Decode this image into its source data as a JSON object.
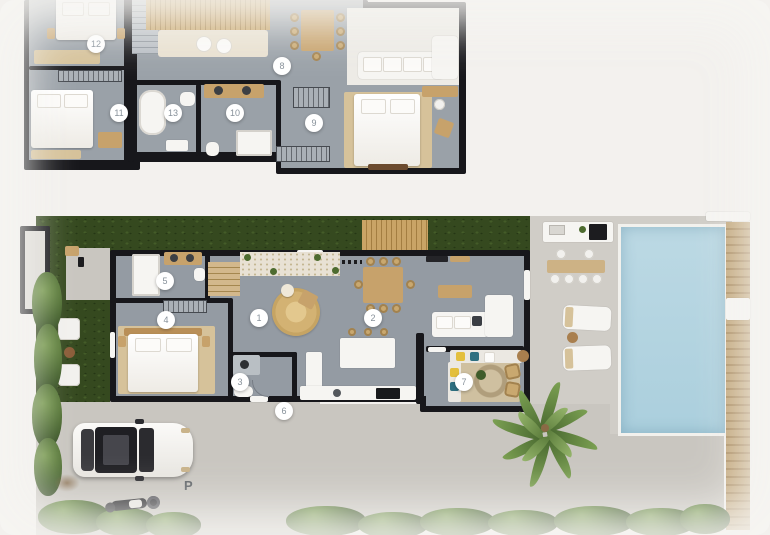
{
  "document": {
    "type": "architectural floor plan rendering",
    "background": "#f3f1ee"
  },
  "palette": {
    "wall": "#17171b",
    "floor": "#9aa1a8",
    "wood": "#c7a26b",
    "lawn_dark": "#35491f",
    "hedge": "#44622b",
    "pool_water": "#b9d8e4",
    "concrete": "#c9c6c0",
    "paver_stripe": "#4c652c",
    "marker_text": "#87919a",
    "rug_jute": "#d9ba7e"
  },
  "upper_floor": {
    "markers": [
      {
        "label": "12"
      },
      {
        "label": "11"
      },
      {
        "label": "13"
      },
      {
        "label": "10"
      },
      {
        "label": "8"
      },
      {
        "label": "9"
      }
    ]
  },
  "ground_floor": {
    "markers": [
      {
        "label": "5"
      },
      {
        "label": "4"
      },
      {
        "label": "1"
      },
      {
        "label": "2"
      },
      {
        "label": "3"
      },
      {
        "label": "6"
      },
      {
        "label": "7"
      }
    ],
    "parking_label": "P"
  }
}
